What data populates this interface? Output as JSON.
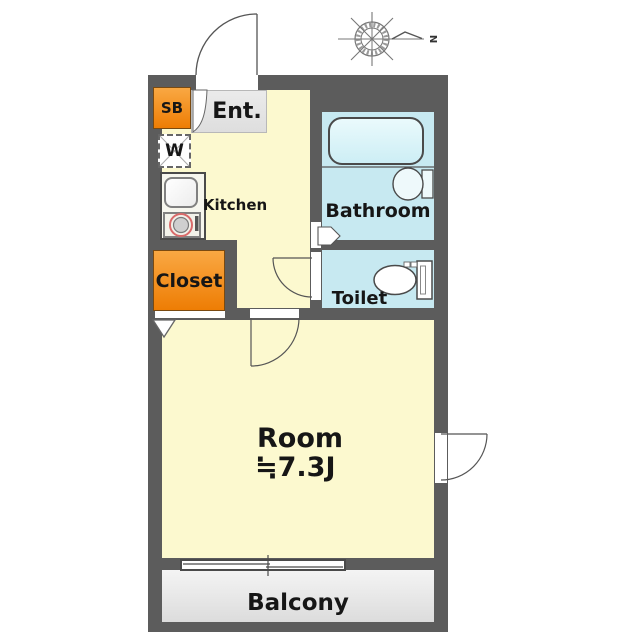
{
  "compass": {
    "north_label": "N"
  },
  "rooms": {
    "shoe_box": {
      "label": "SB"
    },
    "entrance": {
      "label": "Ent."
    },
    "washer": {
      "label": "W"
    },
    "kitchen": {
      "label": "Kitchen"
    },
    "bathroom": {
      "label": "Bathroom"
    },
    "toilet": {
      "label": "Toilet"
    },
    "closet": {
      "label": "Closet"
    },
    "main_room": {
      "label": "Room",
      "size": "≒7.3J"
    },
    "balcony": {
      "label": "Balcony"
    }
  },
  "colors": {
    "wall": "#5c5c5c",
    "floor_yellow": "#fcf9cf",
    "wet_area_blue": "#c7e9f1",
    "storage_orange": "#f28a12",
    "balcony_gray": "#e8e8e8"
  }
}
